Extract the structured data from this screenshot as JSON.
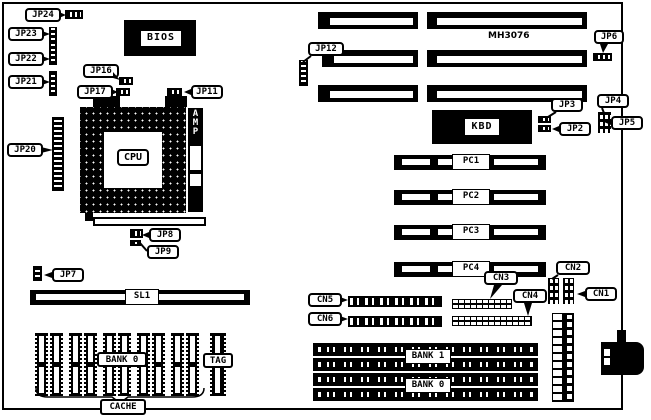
{
  "board": {
    "model": "MH3076"
  },
  "chips": {
    "bios": "BIOS",
    "kbd": "KBD",
    "cpu": "CPU",
    "amp": "A\nM\nP"
  },
  "jumpers": {
    "jp2": "JP2",
    "jp3": "JP3",
    "jp4": "JP4",
    "jp5": "JP5",
    "jp6": "JP6",
    "jp7": "JP7",
    "jp8": "JP8",
    "jp9": "JP9",
    "jp11": "JP11",
    "jp12": "JP12",
    "jp16": "JP16",
    "jp17": "JP17",
    "jp20": "JP20",
    "jp21": "JP21",
    "jp22": "JP22",
    "jp23": "JP23",
    "jp24": "JP24"
  },
  "connectors": {
    "cn1": "CN1",
    "cn2": "CN2",
    "cn3": "CN3",
    "cn4": "CN4",
    "cn5": "CN5",
    "cn6": "CN6"
  },
  "slots": {
    "pc1": "PC1",
    "pc2": "PC2",
    "pc3": "PC3",
    "pc4": "PC4",
    "sl1": "SL1"
  },
  "memory": {
    "bank1": "BANK 1",
    "bank0": "BANK 0"
  },
  "cache": {
    "bank0": "BANK 0",
    "tag": "TAG",
    "label": "CACHE"
  }
}
